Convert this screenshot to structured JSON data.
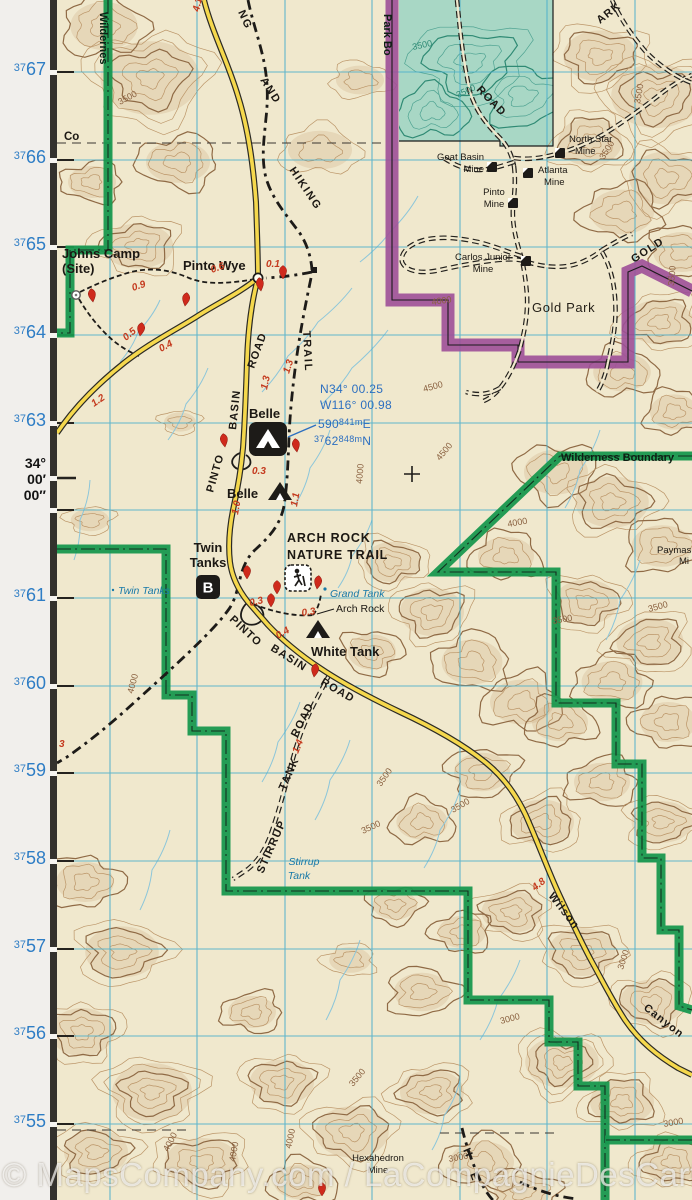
{
  "watermark": "© MapsCompany.com / LaCompagnieDesCartes.fr",
  "colors": {
    "road_yellow": "#f5d84d",
    "wilderness_green": "#18984e",
    "boundary_purple": "#9d4f98",
    "grid_blue": "#49aecc",
    "margin_label_blue": "#2e7dc5",
    "distance_red": "#c43a1e",
    "water_blue": "#1879a8",
    "state_land_teal": "#a8d7c5",
    "map_cream": "#f0e8cd"
  },
  "margin": {
    "grid_labels": [
      {
        "prefix": "37",
        "big": "67",
        "y": 76
      },
      {
        "prefix": "37",
        "big": "66",
        "y": 164
      },
      {
        "prefix": "37",
        "big": "65",
        "y": 251
      },
      {
        "prefix": "37",
        "big": "64",
        "y": 339
      },
      {
        "prefix": "37",
        "big": "63",
        "y": 427
      },
      {
        "prefix": "37",
        "big": "61",
        "y": 602
      },
      {
        "prefix": "37",
        "big": "60",
        "y": 690
      },
      {
        "prefix": "37",
        "big": "59",
        "y": 777
      },
      {
        "prefix": "37",
        "big": "58",
        "y": 865
      },
      {
        "prefix": "37",
        "big": "57",
        "y": 953
      },
      {
        "prefix": "37",
        "big": "56",
        "y": 1040
      },
      {
        "prefix": "37",
        "big": "55",
        "y": 1128
      }
    ],
    "latitude_label": {
      "lines": [
        "34°",
        "00′",
        "00″"
      ],
      "y": 455
    }
  },
  "map": {
    "place_labels": [
      {
        "text": "Johns Camp",
        "x": 62,
        "y": 258,
        "cls": "place"
      },
      {
        "text": "(Site)",
        "x": 62,
        "y": 273,
        "cls": "place"
      },
      {
        "text": "Pinto Wye",
        "x": 183,
        "y": 270,
        "cls": "place"
      },
      {
        "text": "Belle",
        "x": 249,
        "y": 418,
        "cls": "place"
      },
      {
        "text": "Belle",
        "x": 227,
        "y": 498,
        "cls": "place"
      },
      {
        "text": "Twin",
        "x": 208,
        "y": 552,
        "cls": "place",
        "anchor": "middle"
      },
      {
        "text": "Tanks",
        "x": 208,
        "y": 567,
        "cls": "place",
        "anchor": "middle"
      },
      {
        "text": "White Tank",
        "x": 311,
        "y": 656,
        "cls": "place"
      },
      {
        "text": "ARCH ROCK",
        "x": 287,
        "y": 542,
        "cls": "trailname"
      },
      {
        "text": "NATURE TRAIL",
        "x": 287,
        "y": 559,
        "cls": "trailname"
      },
      {
        "text": "Gold Park",
        "x": 532,
        "y": 312,
        "cls": "area"
      },
      {
        "text": "Co",
        "x": 64,
        "y": 140,
        "cls": "small"
      },
      {
        "text": "Arch Rock",
        "x": 336,
        "y": 612,
        "cls": "feature"
      },
      {
        "text": "Wilderness Boundary",
        "x": 561,
        "y": 461,
        "cls": "wild"
      },
      {
        "text": "Hexahedron",
        "x": 378,
        "y": 1161,
        "cls": "mine",
        "anchor": "middle"
      },
      {
        "text": "Mine",
        "x": 378,
        "y": 1173,
        "cls": "mine",
        "anchor": "middle"
      },
      {
        "text": "Paymas",
        "x": 657,
        "y": 553,
        "cls": "mine"
      },
      {
        "text": "Mi",
        "x": 679,
        "y": 564,
        "cls": "mine"
      }
    ],
    "water_labels": [
      {
        "text": "Twin Tanks",
        "x": 118,
        "y": 594
      },
      {
        "text": "Grand Tank",
        "x": 330,
        "y": 597
      },
      {
        "text": "Stirrup",
        "x": 304,
        "y": 865,
        "anchor": "middle"
      },
      {
        "text": "Tank",
        "x": 299,
        "y": 879,
        "anchor": "middle"
      }
    ],
    "rotated_labels": [
      {
        "text": "Wildernes",
        "x": 100,
        "y": 12,
        "rot": 90,
        "cls": "wild"
      },
      {
        "text": "Park Bo",
        "x": 384,
        "y": 14,
        "rot": 90,
        "cls": "wild"
      },
      {
        "text": "NG",
        "x": 238,
        "y": 12,
        "rot": 66,
        "cls": "trail"
      },
      {
        "text": "AND",
        "x": 260,
        "y": 80,
        "rot": 58,
        "cls": "trail"
      },
      {
        "text": "HIKING",
        "x": 289,
        "y": 170,
        "rot": 56,
        "cls": "trail"
      },
      {
        "text": "TRAIL",
        "x": 303,
        "y": 331,
        "rot": 87,
        "cls": "trail"
      },
      {
        "text": "ROAD",
        "x": 254,
        "y": 369,
        "rot": -70,
        "cls": "road"
      },
      {
        "text": "BASIN",
        "x": 236,
        "y": 430,
        "rot": -84,
        "cls": "road"
      },
      {
        "text": "PINTO",
        "x": 213,
        "y": 493,
        "rot": -74,
        "cls": "road"
      },
      {
        "text": "PINTO",
        "x": 229,
        "y": 620,
        "rot": 43,
        "cls": "road"
      },
      {
        "text": "BASIN",
        "x": 270,
        "y": 650,
        "rot": 32,
        "cls": "road"
      },
      {
        "text": "ROAD",
        "x": 320,
        "y": 684,
        "rot": 30,
        "cls": "road"
      },
      {
        "text": "STIRRUP",
        "x": 263,
        "y": 874,
        "rot": -66,
        "cls": "road"
      },
      {
        "text": "TANK",
        "x": 285,
        "y": 791,
        "rot": -66,
        "cls": "road"
      },
      {
        "text": "ROAD",
        "x": 297,
        "y": 738,
        "rot": -63,
        "cls": "road"
      },
      {
        "text": "Wilson",
        "x": 548,
        "y": 896,
        "rot": 52,
        "cls": "road"
      },
      {
        "text": "Canyon",
        "x": 643,
        "y": 1009,
        "rot": 38,
        "cls": "road"
      },
      {
        "text": "GOLD",
        "x": 634,
        "y": 263,
        "rot": -33,
        "cls": "road"
      },
      {
        "text": "ROAD",
        "x": 476,
        "y": 90,
        "rot": 46,
        "cls": "road"
      },
      {
        "text": "ARK",
        "x": 600,
        "y": 24,
        "rot": -38,
        "cls": "road"
      },
      {
        "text": "H",
        "x": 463,
        "y": 1150,
        "rot": 66,
        "cls": "trail"
      },
      {
        "text": "E",
        "x": 470,
        "y": 1174,
        "rot": 70,
        "cls": "trail"
      }
    ],
    "mine_labels": [
      {
        "lines": [
          "North Star",
          "Mine"
        ],
        "x": 569,
        "y": 142,
        "anchor": "start",
        "sym": [
          560,
          153
        ]
      },
      {
        "lines": [
          "Goat Basin",
          "Mine"
        ],
        "x": 484,
        "y": 160,
        "anchor": "end",
        "sym": [
          492,
          167
        ]
      },
      {
        "lines": [
          "Atlanta",
          "Mine"
        ],
        "x": 538,
        "y": 173,
        "anchor": "start",
        "sym": [
          528,
          173
        ]
      },
      {
        "lines": [
          "Pinto",
          "Mine"
        ],
        "x": 494,
        "y": 195,
        "anchor": "middle",
        "sym": [
          513,
          203
        ]
      },
      {
        "lines": [
          "Carlos Junior",
          "Mine"
        ],
        "x": 483,
        "y": 260,
        "anchor": "middle",
        "sym": [
          526,
          261
        ]
      }
    ],
    "distance_labels": [
      {
        "text": "4.1",
        "x": 199,
        "y": 12,
        "rot": -78
      },
      {
        "text": "0.9",
        "x": 133,
        "y": 291,
        "rot": -18
      },
      {
        "text": "0.6",
        "x": 212,
        "y": 273,
        "rot": -20
      },
      {
        "text": "0.1",
        "x": 266,
        "y": 267,
        "rot": 0
      },
      {
        "text": "0.5",
        "x": 126,
        "y": 341,
        "rot": -40
      },
      {
        "text": "0.4",
        "x": 161,
        "y": 352,
        "rot": -28
      },
      {
        "text": "1.2",
        "x": 94,
        "y": 407,
        "rot": -35
      },
      {
        "text": "1.3",
        "x": 267,
        "y": 390,
        "rot": -78
      },
      {
        "text": "1.3",
        "x": 289,
        "y": 374,
        "rot": -72
      },
      {
        "text": "0.3",
        "x": 252,
        "y": 474,
        "rot": 0
      },
      {
        "text": "1.0",
        "x": 238,
        "y": 515,
        "rot": -80
      },
      {
        "text": "1.1",
        "x": 297,
        "y": 507,
        "rot": -80
      },
      {
        "text": "0.3",
        "x": 250,
        "y": 606,
        "rot": -12
      },
      {
        "text": "0.3",
        "x": 302,
        "y": 616,
        "rot": -8
      },
      {
        "text": "0.4",
        "x": 278,
        "y": 639,
        "rot": -30
      },
      {
        "text": "1.4",
        "x": 298,
        "y": 754,
        "rot": -68
      },
      {
        "text": "4.8",
        "x": 535,
        "y": 891,
        "rot": -38
      },
      {
        "text": "3",
        "x": 59,
        "y": 747,
        "rot": 0
      }
    ],
    "contour_labels": [
      {
        "text": "3500",
        "x": 413,
        "y": 50,
        "rot": -12,
        "teal": true
      },
      {
        "text": "3500",
        "x": 458,
        "y": 98,
        "rot": -25,
        "teal": true
      },
      {
        "text": "3500",
        "x": 120,
        "y": 105,
        "rot": -28
      },
      {
        "text": "3500",
        "x": 640,
        "y": 104,
        "rot": -80
      },
      {
        "text": "3500",
        "x": 604,
        "y": 160,
        "rot": -58
      },
      {
        "text": "4000",
        "x": 432,
        "y": 305,
        "rot": -8
      },
      {
        "text": "3500",
        "x": 674,
        "y": 286,
        "rot": -85
      },
      {
        "text": "4500",
        "x": 424,
        "y": 392,
        "rot": -15
      },
      {
        "text": "4500",
        "x": 440,
        "y": 461,
        "rot": -50
      },
      {
        "text": "4000",
        "x": 362,
        "y": 484,
        "rot": -85
      },
      {
        "text": "4000",
        "x": 508,
        "y": 527,
        "rot": -10
      },
      {
        "text": "3500",
        "x": 553,
        "y": 624,
        "rot": -10
      },
      {
        "text": "3500",
        "x": 649,
        "y": 612,
        "rot": -15
      },
      {
        "text": "4000",
        "x": 133,
        "y": 694,
        "rot": -75
      },
      {
        "text": "3500",
        "x": 381,
        "y": 787,
        "rot": -55
      },
      {
        "text": "3500",
        "x": 453,
        "y": 813,
        "rot": -30
      },
      {
        "text": "3500",
        "x": 363,
        "y": 834,
        "rot": -25
      },
      {
        "text": "3000",
        "x": 623,
        "y": 970,
        "rot": -72
      },
      {
        "text": "3000",
        "x": 501,
        "y": 1024,
        "rot": -15
      },
      {
        "text": "3500",
        "x": 353,
        "y": 1087,
        "rot": -50
      },
      {
        "text": "3000",
        "x": 449,
        "y": 1162,
        "rot": -10
      },
      {
        "text": "3000",
        "x": 664,
        "y": 1127,
        "rot": -10
      },
      {
        "text": "4000",
        "x": 291,
        "y": 1149,
        "rot": -78
      },
      {
        "text": "4000",
        "x": 168,
        "y": 1152,
        "rot": -62
      },
      {
        "text": "4000",
        "x": 235,
        "y": 1162,
        "rot": -80
      }
    ],
    "gps": {
      "line1": "N34° 00.25",
      "line2": "W116° 00.98",
      "easting": [
        "590",
        "841m",
        "E"
      ],
      "northing": [
        "37",
        "62",
        "848m",
        "N"
      ]
    }
  }
}
